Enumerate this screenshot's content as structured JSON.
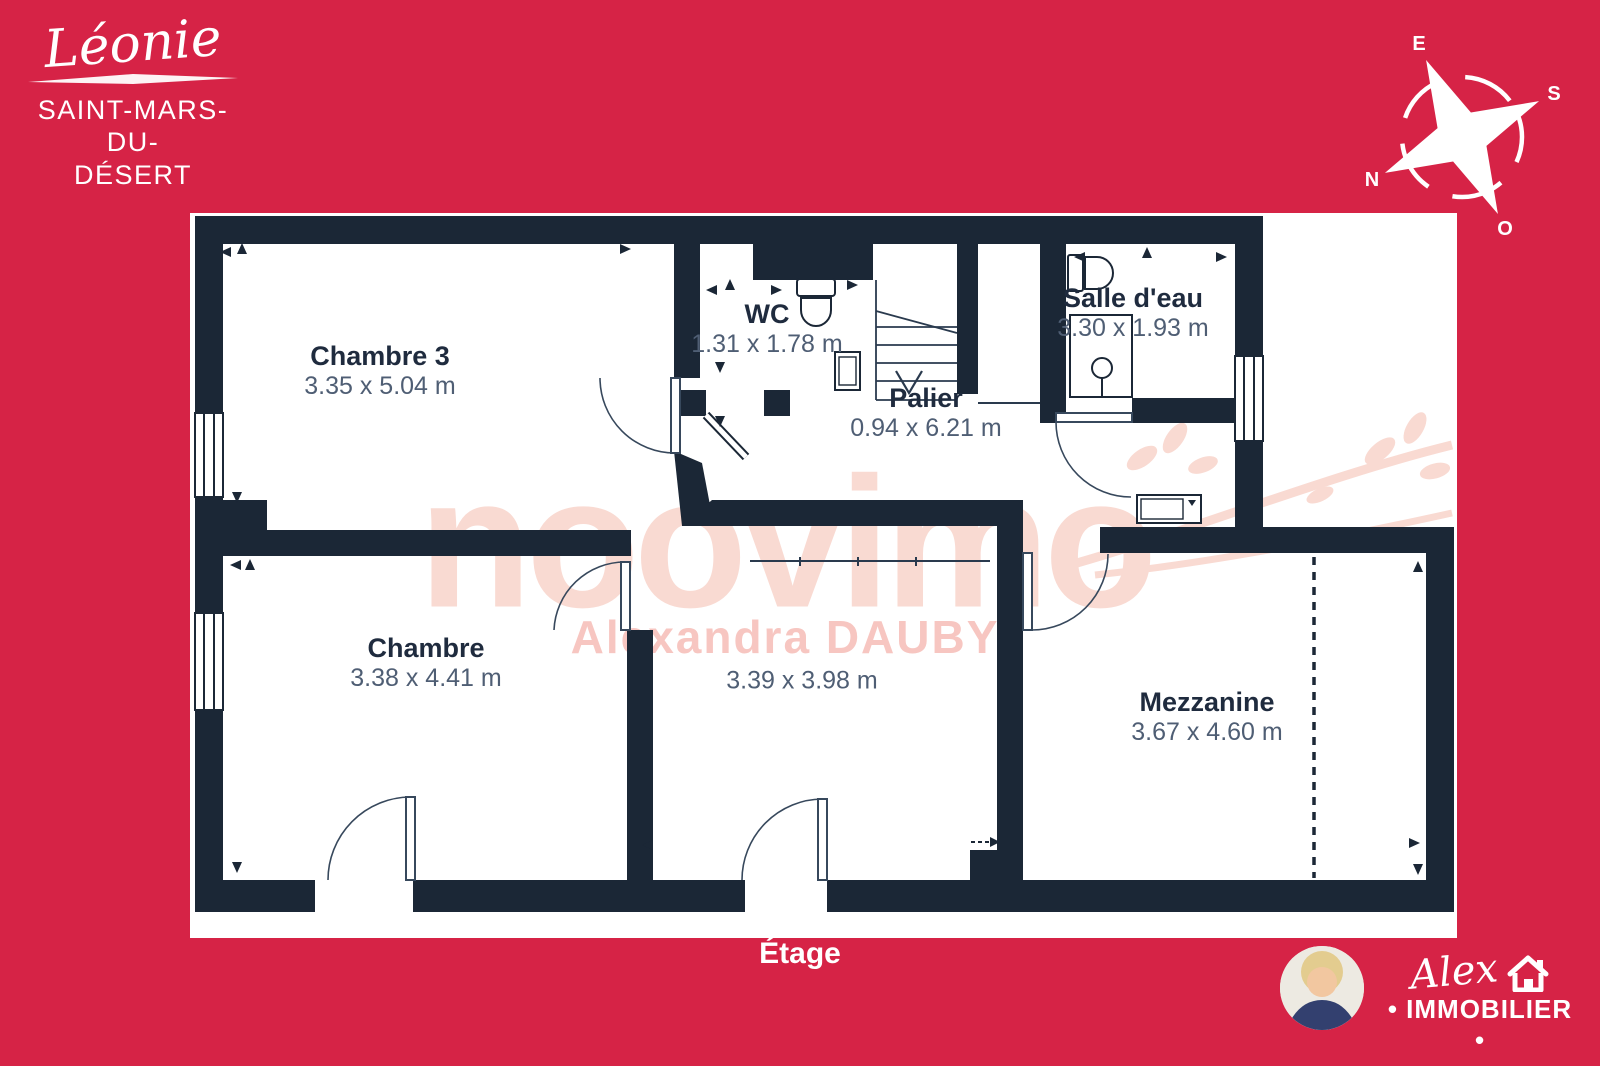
{
  "header": {
    "estate_name": "Léonie",
    "city_line1": "SAINT-MARS-DU-",
    "city_line2": "DÉSERT"
  },
  "compass": {
    "top": "E",
    "right": "S",
    "bottom_left": "N",
    "bottom": "O"
  },
  "rooms": {
    "chambre3": {
      "name": "Chambre 3",
      "dims": "3.35 x 5.04 m"
    },
    "wc": {
      "name": "WC",
      "dims": "1.31 x 1.78 m"
    },
    "palier": {
      "name": "Palier",
      "dims": "0.94 x 6.21 m"
    },
    "salle_deau": {
      "name": "Salle d'eau",
      "dims": "3.30 x 1.93 m"
    },
    "chambre": {
      "name": "Chambre",
      "dims": "3.38 x 4.41 m"
    },
    "room_center": {
      "dims": "3.39 x 3.98 m"
    },
    "mezzanine": {
      "name": "Mezzanine",
      "dims": "3.67 x 4.60 m"
    }
  },
  "floor_label": "Étage",
  "watermark": {
    "brand": "noovimo",
    "agent": "Alexandra DAUBY"
  },
  "footer": {
    "agency_script": "Alex",
    "agency_caps": "• IMMOBILIER •"
  },
  "colors": {
    "background": "#D62346",
    "walls": "#1B2736",
    "dimension_text": "#4F5E74",
    "watermark_pink": "#F9DAD2",
    "watermark_agent_pink": "#F7C6C1"
  }
}
